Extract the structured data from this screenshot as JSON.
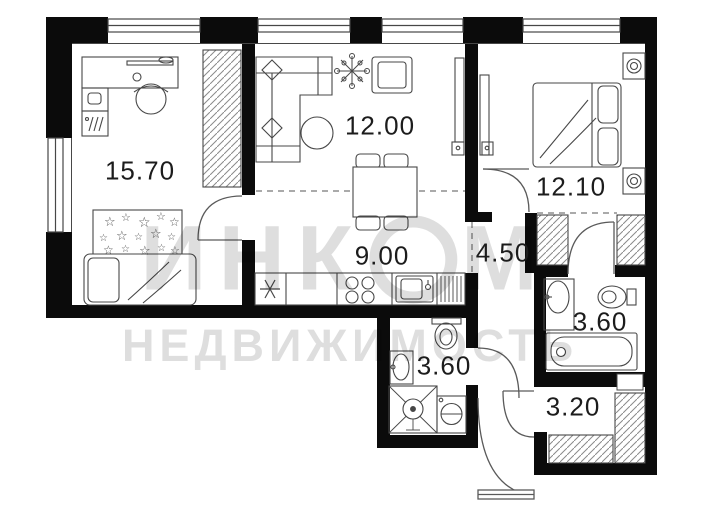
{
  "plan": {
    "title": "apartment-floor-plan",
    "rooms": [
      {
        "name": "bedroom-left",
        "area": "15.70"
      },
      {
        "name": "living-room",
        "area": "12.00"
      },
      {
        "name": "bedroom-right",
        "area": "12.10"
      },
      {
        "name": "kitchen",
        "area": "9.00"
      },
      {
        "name": "hallway",
        "area": "4.50"
      },
      {
        "name": "bathroom-right",
        "area": "3.60"
      },
      {
        "name": "bathroom-middle",
        "area": "3.60"
      },
      {
        "name": "storage-room",
        "area": "3.20"
      }
    ],
    "watermark": {
      "line1_full": "ИНКОМ",
      "line1_pre": "ИНК",
      "line1_post": "М",
      "line2": "НЕДВИЖИМОСТЬ"
    },
    "colors": {
      "wall": "#0b0b0b",
      "line": "#474747",
      "background": "#ffffff",
      "watermark": "rgba(0,0,0,0.13)"
    }
  }
}
